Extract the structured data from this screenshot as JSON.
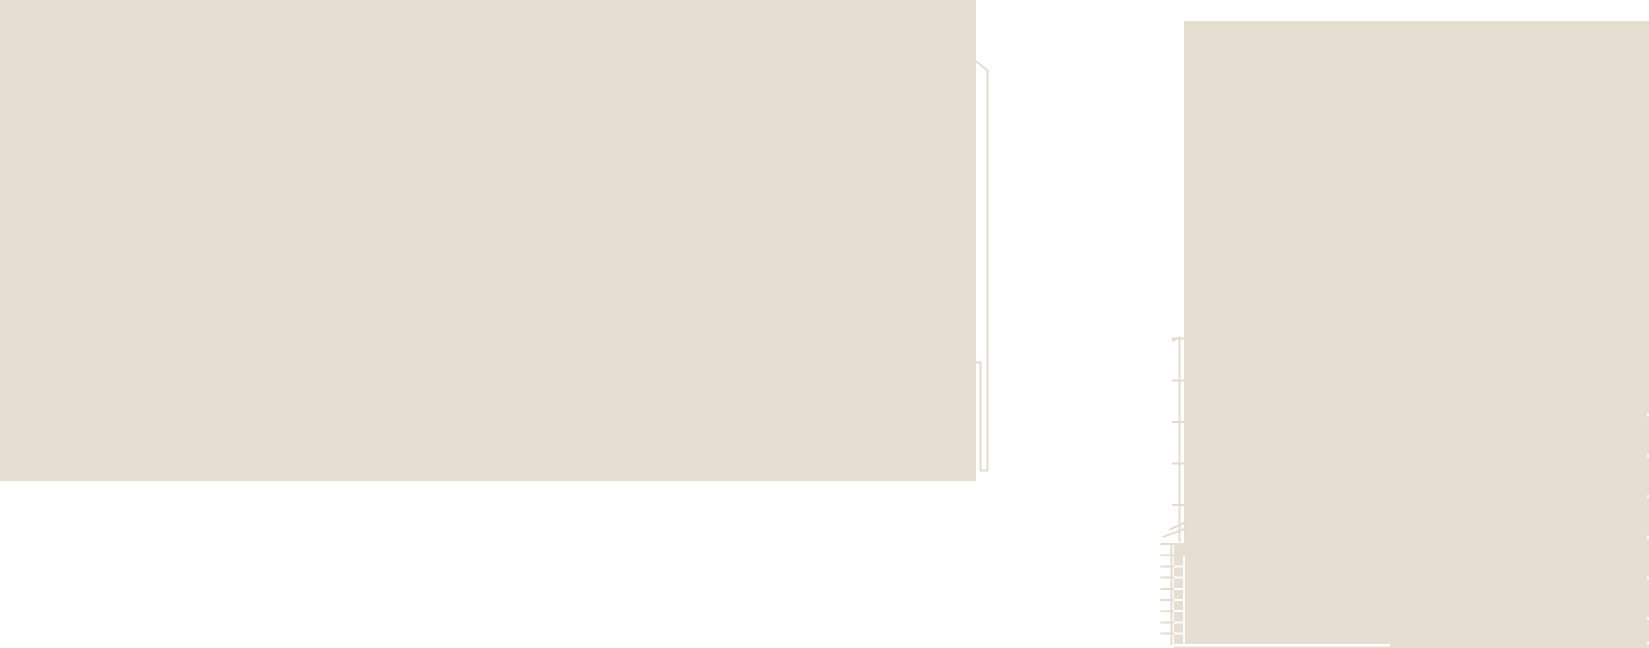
{
  "canvas": {
    "width": 1649,
    "height": 648
  },
  "colors": {
    "road_white": "#ffffff",
    "land_beige": "#e5ded1",
    "outline_beige": "#e3dbcd",
    "edge_white": "#fcfbf9"
  },
  "map": {
    "description": "max-zoom map tile: two beige building/land footprints separated by white road, annex outline, passage tick line, stair symbol, edge dashes",
    "shapes": [
      {
        "name": "left-building-footprint",
        "d": "M0,0 H976 V481 H0 Z",
        "fill": "land_beige"
      },
      {
        "name": "right-building-footprint",
        "d": "M1184,21 H1649 V648 H1174 V543 H1184 Z",
        "fill": "land_beige"
      },
      {
        "name": "annex-outline",
        "d": "M976,61 L987.5,70.5 V470.5 H980.5 V362.5 H976",
        "stroke": "outline_beige",
        "w": 1.8
      },
      {
        "name": "passage-line",
        "d": "M1172,341 L1179.5,337.5 V542",
        "stroke": "outline_beige",
        "w": 1.9
      },
      {
        "name": "passage-tick-1",
        "d": "M1172,338.5 H1185",
        "stroke": "outline_beige",
        "w": 1.9
      },
      {
        "name": "passage-tick-2",
        "d": "M1172,380.5 H1185",
        "stroke": "outline_beige",
        "w": 1.9
      },
      {
        "name": "passage-tick-3",
        "d": "M1172,422 H1185",
        "stroke": "outline_beige",
        "w": 1.9
      },
      {
        "name": "passage-tick-4",
        "d": "M1172,463.5 H1185",
        "stroke": "outline_beige",
        "w": 1.9
      },
      {
        "name": "passage-tick-5",
        "d": "M1172,505 H1185",
        "stroke": "outline_beige",
        "w": 1.9
      },
      {
        "name": "stair-diagonal-1",
        "d": "M1163,537 L1187,528",
        "stroke": "outline_beige",
        "w": 1.9
      },
      {
        "name": "stair-diagonal-2",
        "d": "M1169,530 L1187,521.5",
        "stroke": "outline_beige",
        "w": 1.9
      },
      {
        "name": "stair-left-rail",
        "d": "M1171.5,543 V645",
        "stroke": "outline_beige",
        "w": 1.9
      },
      {
        "name": "stair-step-1",
        "d": "M1160.5,544 H1175",
        "stroke": "outline_beige",
        "w": 1.9
      },
      {
        "name": "stair-step-2",
        "d": "M1160.5,555.2 H1175",
        "stroke": "outline_beige",
        "w": 1.9
      },
      {
        "name": "stair-step-3",
        "d": "M1160.5,566.4 H1175",
        "stroke": "outline_beige",
        "w": 1.9
      },
      {
        "name": "stair-step-4",
        "d": "M1160.5,577.6 H1175",
        "stroke": "outline_beige",
        "w": 1.9
      },
      {
        "name": "stair-step-5",
        "d": "M1160.5,588.8 H1175",
        "stroke": "outline_beige",
        "w": 1.9
      },
      {
        "name": "stair-step-6",
        "d": "M1160.5,600 H1175",
        "stroke": "outline_beige",
        "w": 1.9
      },
      {
        "name": "stair-step-7",
        "d": "M1160.5,611.2 H1175",
        "stroke": "outline_beige",
        "w": 1.9
      },
      {
        "name": "stair-step-8",
        "d": "M1160.5,622.4 H1175",
        "stroke": "outline_beige",
        "w": 1.9
      },
      {
        "name": "stair-step-9",
        "d": "M1160.5,633.6 H1175",
        "stroke": "outline_beige",
        "w": 1.9
      },
      {
        "name": "stair-right-rail-white",
        "d": "M1184,556 V644",
        "stroke": "road_white",
        "w": 2.2
      },
      {
        "name": "stair-step-white-1",
        "d": "M1174,566.4 H1185.2",
        "stroke": "road_white",
        "w": 2
      },
      {
        "name": "stair-step-white-2",
        "d": "M1174,577.6 H1185.2",
        "stroke": "road_white",
        "w": 2
      },
      {
        "name": "stair-step-white-3",
        "d": "M1174,588.8 H1185.2",
        "stroke": "road_white",
        "w": 2
      },
      {
        "name": "stair-step-white-4",
        "d": "M1174,600 H1185.2",
        "stroke": "road_white",
        "w": 2
      },
      {
        "name": "stair-step-white-5",
        "d": "M1174,611.2 H1185.2",
        "stroke": "road_white",
        "w": 2
      },
      {
        "name": "stair-step-white-6",
        "d": "M1174,622.4 H1185.2",
        "stroke": "road_white",
        "w": 2
      },
      {
        "name": "stair-step-white-7",
        "d": "M1174,633.6 H1185.2",
        "stroke": "road_white",
        "w": 2
      },
      {
        "name": "building-bottom-edge-white",
        "d": "M1172,645 H1390",
        "stroke": "road_white",
        "w": 2.5
      },
      {
        "name": "right-edge-dash-1",
        "d": "M1648.3,413.5 v3.2",
        "stroke": "edge_white",
        "w": 2.6
      },
      {
        "name": "right-edge-dash-2",
        "d": "M1648.3,454.2 v3.2",
        "stroke": "edge_white",
        "w": 2.6
      },
      {
        "name": "right-edge-dash-3",
        "d": "M1648.3,494.9 v3.2",
        "stroke": "edge_white",
        "w": 2.6
      },
      {
        "name": "right-edge-dash-4",
        "d": "M1648.3,535.6 v3.2",
        "stroke": "edge_white",
        "w": 2.6
      },
      {
        "name": "right-edge-dash-5",
        "d": "M1648.3,576.3 v3.2",
        "stroke": "edge_white",
        "w": 2.6
      },
      {
        "name": "right-edge-dash-6",
        "d": "M1648.3,617 v3.2",
        "stroke": "edge_white",
        "w": 2.6
      },
      {
        "name": "right-edge-dash-7",
        "d": "M1648.3,641.5 v3.2",
        "stroke": "edge_white",
        "w": 2.6
      }
    ]
  }
}
